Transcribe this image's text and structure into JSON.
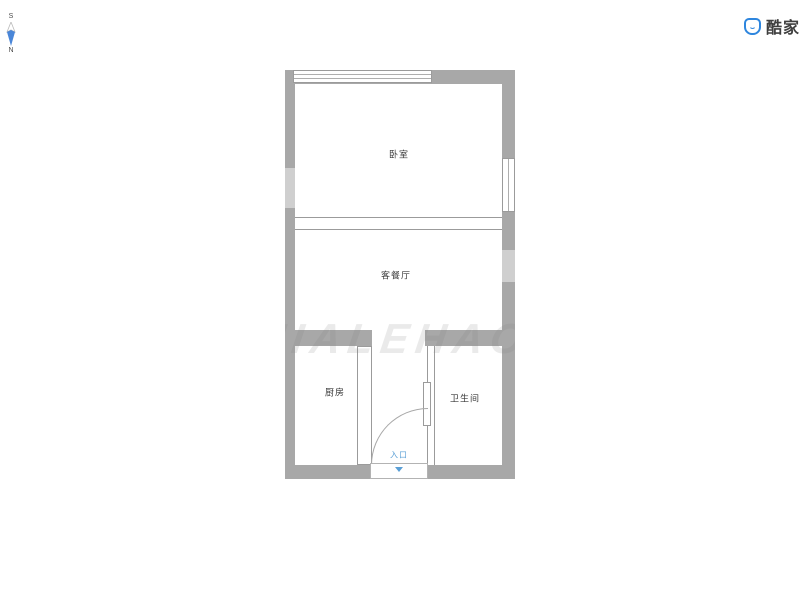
{
  "header": {
    "compass": {
      "icon": "compass-icon",
      "south": "S",
      "north": "N",
      "needle_color": "#4a86d8"
    },
    "brand": {
      "icon": "kujiale-badge-icon",
      "icon_color": "#2e86de",
      "name": "酷家乐",
      "text_color": "#3f3f3f"
    }
  },
  "floorplan": {
    "wall_color": "#a8a8a8",
    "line_color": "#9b9b9b",
    "rooms": [
      {
        "id": "bedroom",
        "label": "卧室"
      },
      {
        "id": "living-dining",
        "label": "客餐厅"
      },
      {
        "id": "kitchen",
        "label": "厨房"
      },
      {
        "id": "bathroom",
        "label": "卫生间"
      }
    ],
    "entrance": {
      "label": "入口",
      "color": "#5a9fd6",
      "arrow_icon": "triangle-down-icon"
    },
    "features": {
      "top_window": "window",
      "right_window": "window",
      "bedroom_living_divider": "double-line opening",
      "entrance_door": "quarter-circle swing",
      "kitchen_door": "sliding panel",
      "bathroom_door": "sliding panel"
    },
    "watermark": {
      "text": "KUJIALEHAOFANGAN"
    }
  }
}
